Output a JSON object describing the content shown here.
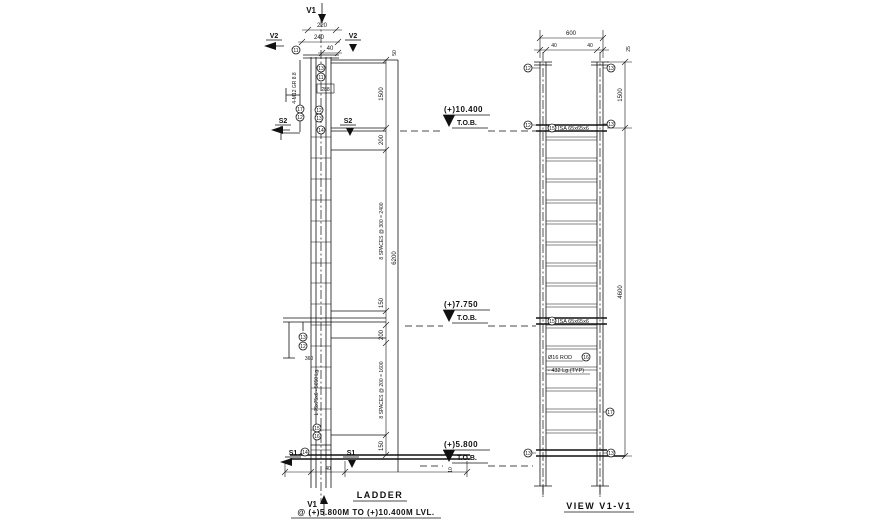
{
  "titles": {
    "ladder": "LADDER",
    "ladder_sub": "@ (+)5.800M TO (+)10.400M LVL.",
    "view": "VIEW V1-V1"
  },
  "marks": {
    "v1": "V1",
    "v2": "V2",
    "s1": "S1",
    "s2": "S2"
  },
  "levels": [
    {
      "value": "(+)10.400",
      "datum": "T.O.B."
    },
    {
      "value": "(+)7.750",
      "datum": "T.O.B."
    },
    {
      "value": "(+)5.800",
      "datum": "T.O.B."
    }
  ],
  "dims": {
    "top_1": "220",
    "top_2": "240",
    "top_3": "40",
    "chain_1": "1500",
    "chain_2": "200",
    "chain_3": "8 SPACES @ 300 = 2400",
    "chain_4": "150",
    "chain_5": "200",
    "chain_6": "8 SPACES @ 200 = 1600",
    "chain_7": "150",
    "total_left": "6200",
    "offset_top": "50",
    "bottom_1": "40",
    "bottom_2": "10",
    "rung_pitch": "288",
    "bracket": "360",
    "sec_width": "600",
    "sec_left": "40",
    "sec_right": "40",
    "sec_edge": "25",
    "sec_upper": "1500",
    "sec_total": "4600"
  },
  "notes": {
    "stringer": "L 75x75x6 - 5650 Lg.",
    "bolts": "4-M12 GR 8.8",
    "landing_angle": "ISA 65x65x6",
    "rung_1": "Ø16 ROD",
    "rung_2": "- 432 Lg.(TYP)"
  },
  "callouts": {
    "n10": "10",
    "n11": "11",
    "n12": "12",
    "n13": "13",
    "n14": "14",
    "n15": "15",
    "n16": "16",
    "n17": "17"
  }
}
